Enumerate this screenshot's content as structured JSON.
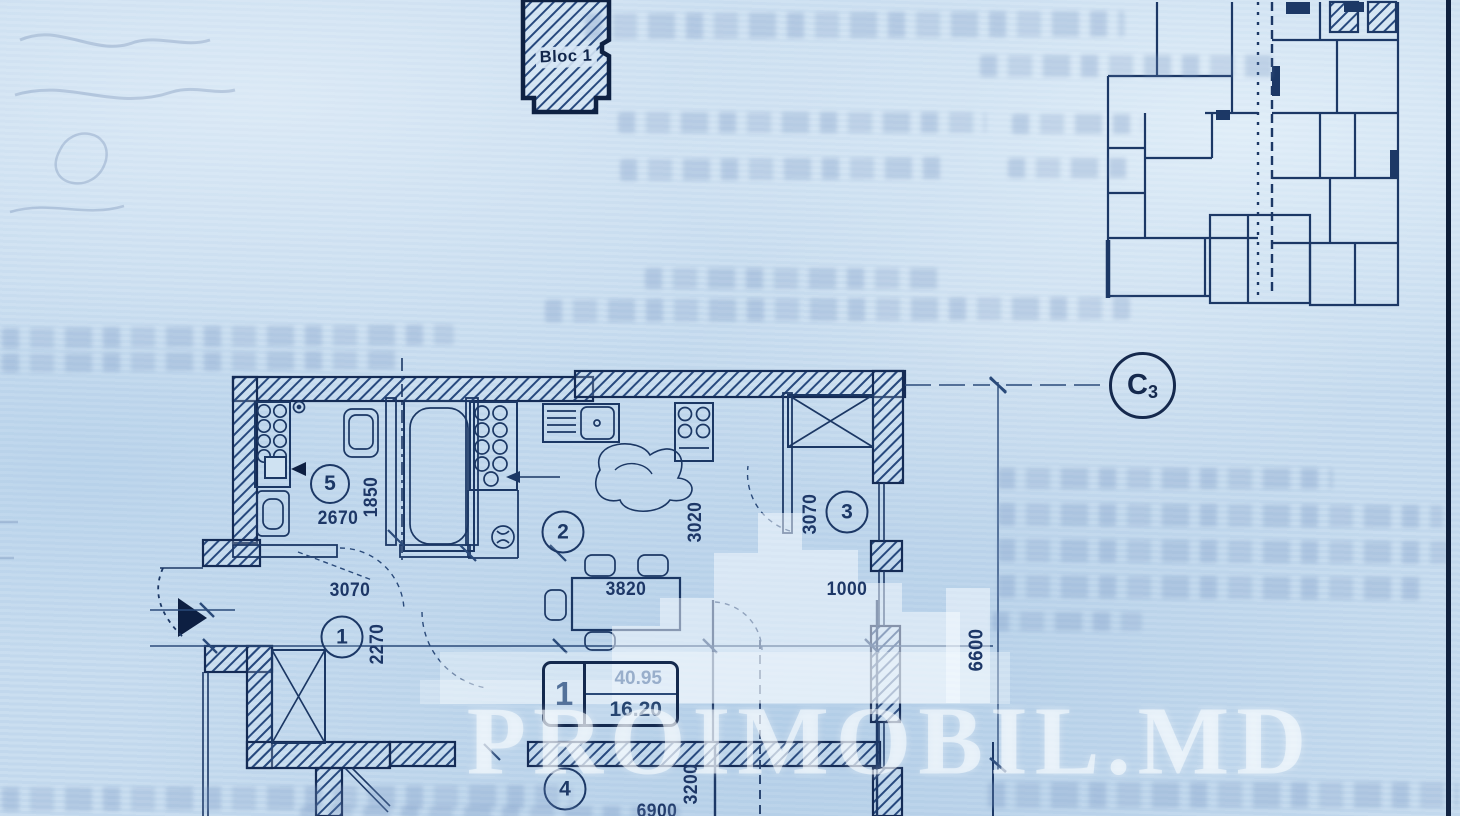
{
  "scan": {
    "watermark": "PROIMOBIL.MD",
    "block_marker_label": "Bloc 1",
    "axis": {
      "letter": "C",
      "number": "3"
    },
    "unit_tag": {
      "number": "1",
      "area_top": "40.95",
      "area_bottom": "16.20"
    },
    "room_numbers": {
      "hall": "1",
      "kitchen": "2",
      "room3": "3",
      "room4": "4",
      "bathroom": "5"
    },
    "dimensions": {
      "bathroom_width": "2670",
      "bathroom_depth": "1850",
      "hall_width": "3070",
      "hall_depth": "2270",
      "kitchen_table": "3820",
      "kitchen_depth": "3020",
      "room3_depth": "3070",
      "room3_width": "1000",
      "side_total": "6600",
      "bottom_width": "6900",
      "bottom_depth": "3200"
    }
  }
}
